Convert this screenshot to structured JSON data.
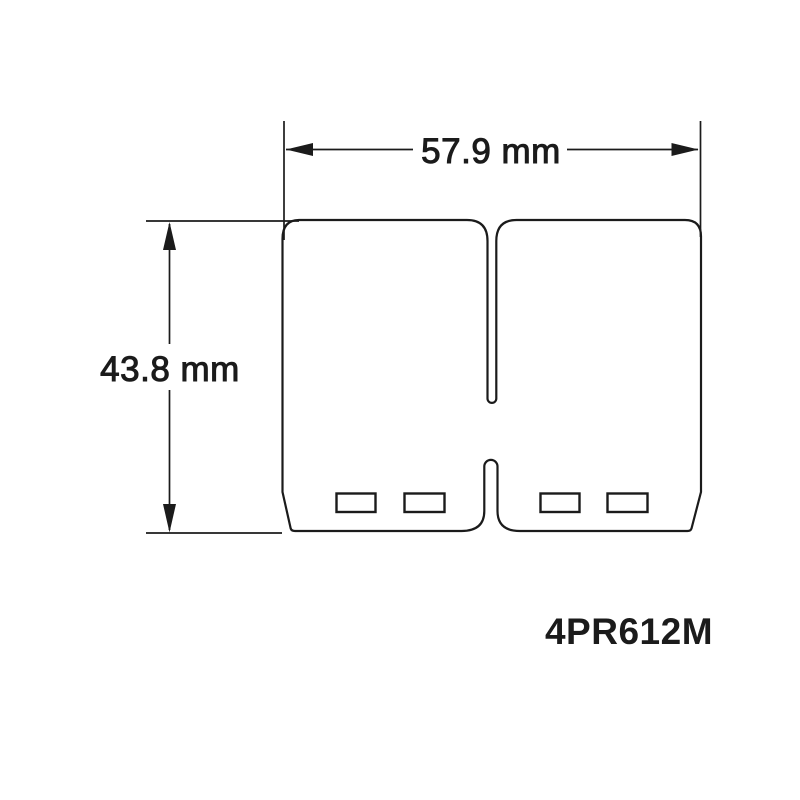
{
  "drawing": {
    "dimensions": {
      "width_label": "57.9 mm",
      "height_label": "43.8 mm"
    },
    "part_number": "4PR612M",
    "colors": {
      "line": "#1b1b1b",
      "text": "#1b1b1b",
      "background": "#ffffff"
    }
  }
}
